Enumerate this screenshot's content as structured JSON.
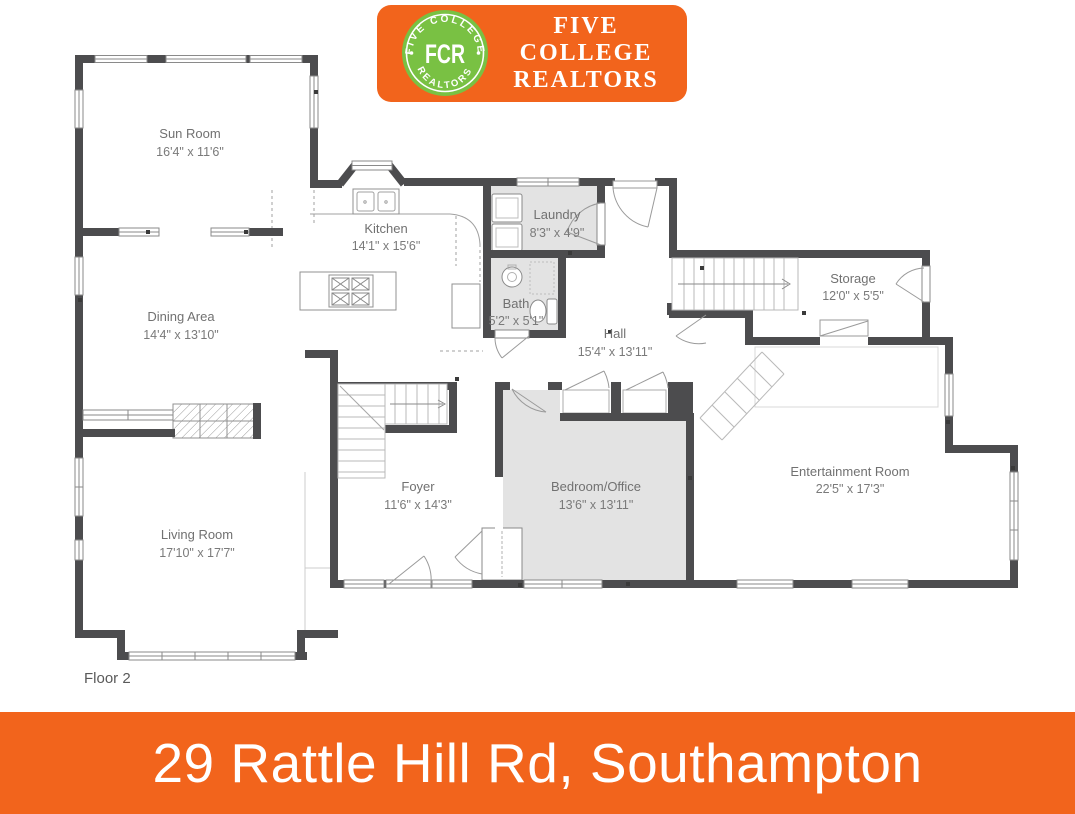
{
  "branding": {
    "logo_monogram": "FCR",
    "logo_arc_top": "FIVE COLLEGE",
    "logo_arc_bottom": "REALTORS",
    "company_name_line1": "FIVE",
    "company_name_line2": "COLLEGE",
    "company_name_line3": "REALTORS",
    "colors": {
      "orange": "#F2641C",
      "green": "#79C143",
      "wall_gray": "#4C4C4E",
      "room_fill": "#E3E3E3",
      "label_gray": "#717171"
    }
  },
  "floor_plan": {
    "floor_label": "Floor 2",
    "rooms": [
      {
        "name": "Sun Room",
        "dimensions": "16'4\" x 11'6\""
      },
      {
        "name": "Kitchen",
        "dimensions": "14'1\" x 15'6\""
      },
      {
        "name": "Laundry",
        "dimensions": "8'3\" x 4'9\""
      },
      {
        "name": "Bath",
        "dimensions": "5'2\" x 5'1\""
      },
      {
        "name": "Hall",
        "dimensions": "15'4\" x 13'11\""
      },
      {
        "name": "Storage",
        "dimensions": "12'0\" x 5'5\""
      },
      {
        "name": "Dining Area",
        "dimensions": "14'4\" x 13'10\""
      },
      {
        "name": "Foyer",
        "dimensions": "11'6\" x 14'3\""
      },
      {
        "name": "Bedroom/Office",
        "dimensions": "13'6\" x 13'11\""
      },
      {
        "name": "Entertainment Room",
        "dimensions": "22'5\" x 17'3\""
      },
      {
        "name": "Living Room",
        "dimensions": "17'10\" x 17'7\""
      }
    ]
  },
  "footer": {
    "address": "29 Rattle Hill Rd, Southampton"
  }
}
